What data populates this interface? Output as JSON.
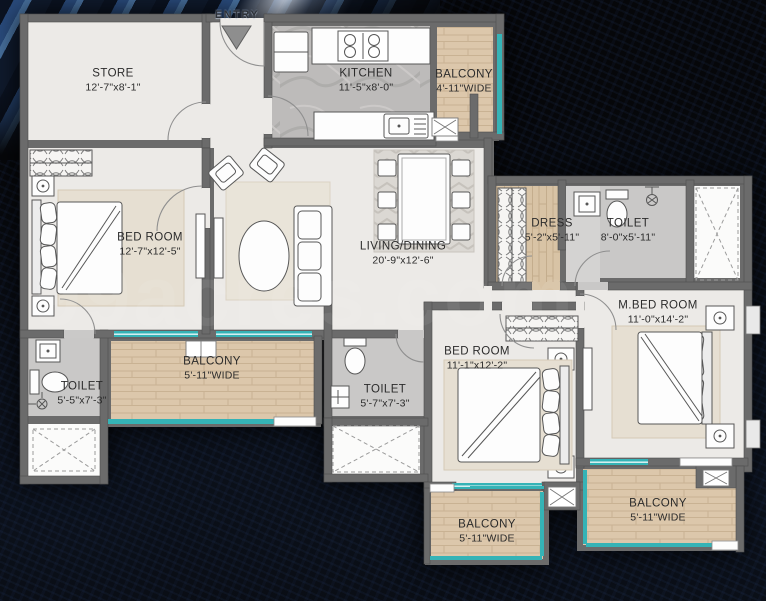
{
  "watermark": "99acres.com",
  "entry": {
    "label": "ENTRY"
  },
  "rooms": {
    "store": {
      "name": "STORE",
      "dims": "12'-7\"x8'-1\""
    },
    "kitchen": {
      "name": "KITCHEN",
      "dims": "11'-5\"x8'-0\""
    },
    "kitchen_balcony": {
      "name": "BALCONY",
      "dims": "4'-11\"WIDE"
    },
    "bedroom1": {
      "name": "BED ROOM",
      "dims": "12'-7\"x12'-5\""
    },
    "living": {
      "name": "LIVING/DINING",
      "dims": "20'-9\"x12'-6\""
    },
    "dress": {
      "name": "DRESS",
      "dims": "5'-2\"x5'-11\""
    },
    "toilet_top": {
      "name": "TOILET",
      "dims": "8'-0\"x5'-11\""
    },
    "mbedroom": {
      "name": "M.BED ROOM",
      "dims": "11'-0\"x14'-2\""
    },
    "balcony_left": {
      "name": "BALCONY",
      "dims": "5'-11\"WIDE"
    },
    "toilet_left": {
      "name": "TOILET",
      "dims": "5'-5\"x7'-3\""
    },
    "toilet_mid": {
      "name": "TOILET",
      "dims": "5'-7\"x7'-3\""
    },
    "bedroom2": {
      "name": "BED ROOM",
      "dims": "11'-1\"x12'-2\""
    },
    "balcony_bc": {
      "name": "BALCONY",
      "dims": "5'-11\"WIDE"
    },
    "balcony_br": {
      "name": "BALCONY",
      "dims": "5'-11\"WIDE"
    }
  },
  "colors": {
    "wall": "#6b6b6b",
    "floor_light": "#eceae7",
    "floor_tile": "#c9c8c7",
    "wood": "#dcc7ab",
    "window_teal": "#35b3b6",
    "background": "#06070a"
  }
}
